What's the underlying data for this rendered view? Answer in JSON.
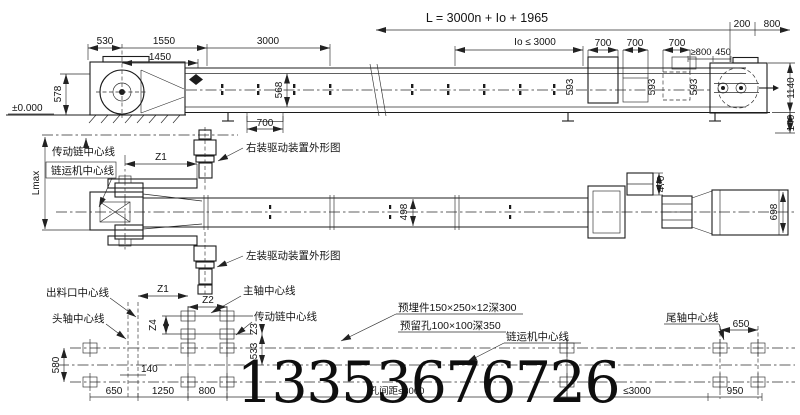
{
  "watermark": "13353676726",
  "side": {
    "formula": "L = 3000n + Io + 1965",
    "io": "Io ≤ 3000",
    "d530": "530",
    "d1550": "1550",
    "d1450": "1450",
    "d3000": "3000",
    "d700a": "700",
    "d700b": "700",
    "d700c": "700",
    "d700s": "700",
    "ge800": "≥800",
    "d450": "450",
    "d200": "200",
    "d800": "800",
    "d593a": "593",
    "d593b": "593",
    "d593c": "593",
    "d568": "568",
    "d578": "578",
    "d1140": "1140",
    "d140": "140",
    "datum": "±0.000"
  },
  "plan": {
    "chain_cl": "传动链中心线",
    "conveyor_cl": "链运机中心线",
    "lmax": "Lmax",
    "z1": "Z1",
    "right_drive": "右装驱动装置外形图",
    "left_drive": "左装驱动装置外形图",
    "d498": "498",
    "d470": "470",
    "d698": "698"
  },
  "found": {
    "outlet_cl": "出料口中心线",
    "head_cl": "头轴中心线",
    "main_cl": "主轴中心线",
    "chain_cl": "传动链中心线",
    "conveyor_cl": "链运机中心线",
    "tail_cl": "尾轴中心线",
    "embed": "预埋件150×250×12深300",
    "hole": "预留孔100×100深350",
    "spacing": "孔间距≤3000",
    "z1": "Z1",
    "z2": "Z2",
    "z3": "Z3",
    "z4": "Z4",
    "d533": "533",
    "d580": "580",
    "d140": "140",
    "d650l": "650",
    "d1250": "1250",
    "d800": "800",
    "d650r": "650",
    "d950": "950",
    "le3000": "≤3000"
  }
}
